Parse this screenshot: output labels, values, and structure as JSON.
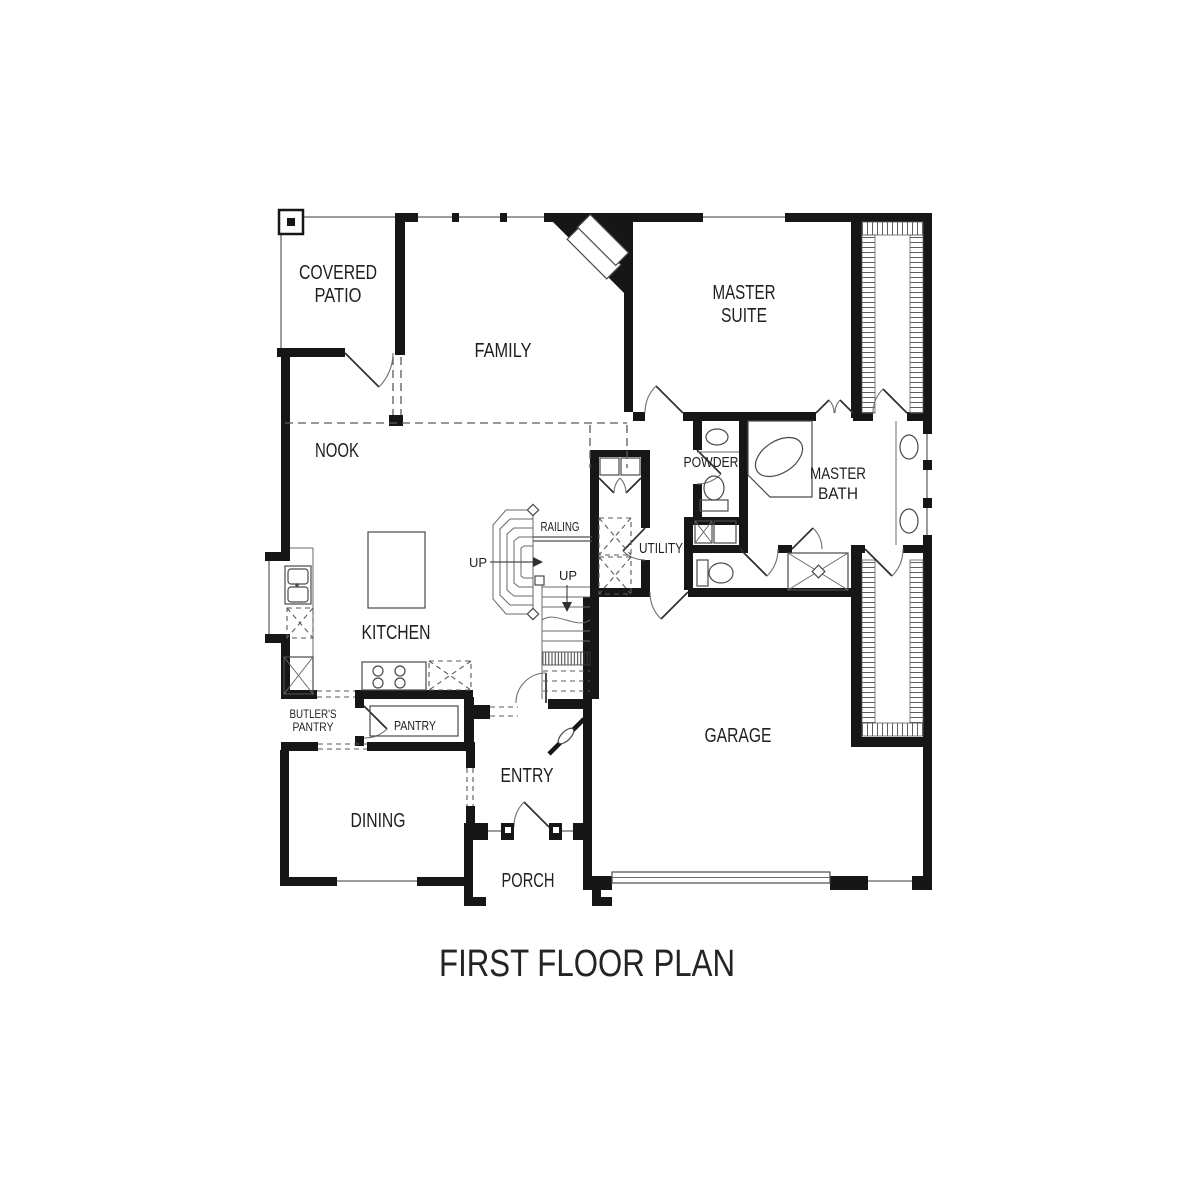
{
  "page": {
    "background_color": "#ffffff",
    "ink_color": "#161616",
    "window_line_color": "#9c9c9c"
  },
  "title": {
    "text": "FIRST FLOOR PLAN"
  },
  "rooms": {
    "covered_patio": {
      "line1": "COVERED",
      "line2": "PATIO"
    },
    "family": {
      "label": "FAMILY"
    },
    "master_suite": {
      "line1": "MASTER",
      "line2": "SUITE"
    },
    "nook": {
      "label": "NOOK"
    },
    "kitchen": {
      "label": "KITCHEN"
    },
    "powder": {
      "label": "POWDER"
    },
    "master_bath": {
      "line1": "MASTER",
      "line2": "BATH"
    },
    "utility": {
      "label": "UTILITY"
    },
    "butlers_pantry": {
      "line1": "BUTLER'S",
      "line2": "PANTRY"
    },
    "pantry": {
      "label": "PANTRY"
    },
    "dining": {
      "label": "DINING"
    },
    "entry": {
      "label": "ENTRY"
    },
    "garage": {
      "label": "GARAGE"
    },
    "porch": {
      "label": "PORCH"
    }
  },
  "stairs": {
    "railing_label": "RAILING",
    "up_label_winder": "UP",
    "up_label_run": "UP"
  }
}
